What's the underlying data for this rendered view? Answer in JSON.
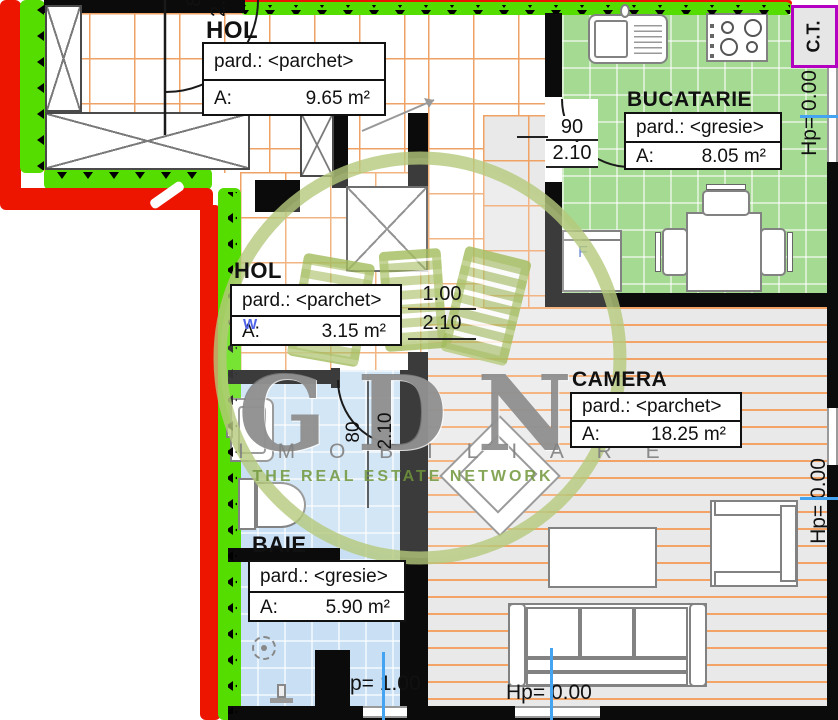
{
  "rooms": [
    {
      "id": "hol-top",
      "title": "HOL",
      "pard": "pard.: <parchet>",
      "area_label": "A:",
      "area_value": "9.65 m²"
    },
    {
      "id": "bucatarie",
      "title": "BUCATARIE",
      "pard": "pard.: <gresie>",
      "area_label": "A:",
      "area_value": "8.05 m²"
    },
    {
      "id": "hol-mid",
      "title": "HOL",
      "pard": "pard.: <parchet>",
      "area_label": "A:",
      "area_value": "3.15 m²"
    },
    {
      "id": "camera",
      "title": "CAMERA",
      "pard": "pard.: <parchet>",
      "area_label": "A:",
      "area_value": "18.25 m²"
    },
    {
      "id": "baie",
      "title": "BAIE",
      "pard": "pard.: <gresie>",
      "area_label": "A:",
      "area_value": "5.90 m²"
    }
  ],
  "dims": {
    "kitchen_w": "90",
    "kitchen_h": "2.10",
    "hall_w": "1.00",
    "hall_h": "2.10",
    "bath_w": "80",
    "bath_h": "2.10",
    "entry_w": "80",
    "entry_h": "2.10"
  },
  "markers": {
    "hp_zero": "Hp= 0.00",
    "hp_bath": "p= 1.00",
    "ct": "C.T.",
    "fridge": "F",
    "w_symbol": "W"
  },
  "watermark": {
    "initials": "GDN",
    "company": "I M O B I L I A R E",
    "tagline": "THE REAL ESTATE NETWORK"
  },
  "colors": {
    "wall": "#0b0b0b",
    "exterior_red": "#ee1500",
    "exterior_green": "#55dd00",
    "kitchen_floor": "#a5da93",
    "bath_floor": "#c9e0f4",
    "camera_floor": "#e9e9e9",
    "tile_grid_orange": "#efa265",
    "marker_blue": "#45a4f2",
    "ct_border": "#b400c0",
    "watermark_olive": "#a4bc5e"
  }
}
